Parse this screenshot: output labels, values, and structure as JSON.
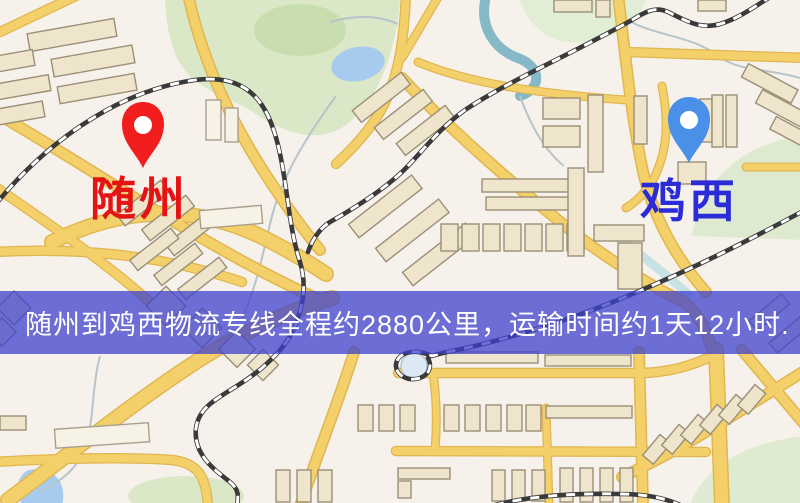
{
  "banner": {
    "text": "随州到鸡西物流专线全程约2880公里，运输时间约1天12小时.",
    "background": "rgba(62,66,206,0.75)",
    "text_color": "#FFFFFF"
  },
  "map": {
    "origin_marker": {
      "label": "随州",
      "pin_color": "#F21D1D",
      "label_color": "#E51313"
    },
    "destination_marker": {
      "label": "鸡西",
      "pin_color": "#4A8FE8",
      "label_color": "#2B2BD8"
    }
  },
  "colors": {
    "land": "#F6F1EA",
    "road": "#F4D06A",
    "road_border": "#E0B650",
    "park": "#DAE8C8",
    "water": "#A6CBEF",
    "railway": "#3A3A3A",
    "building": "#EFE5CC"
  }
}
